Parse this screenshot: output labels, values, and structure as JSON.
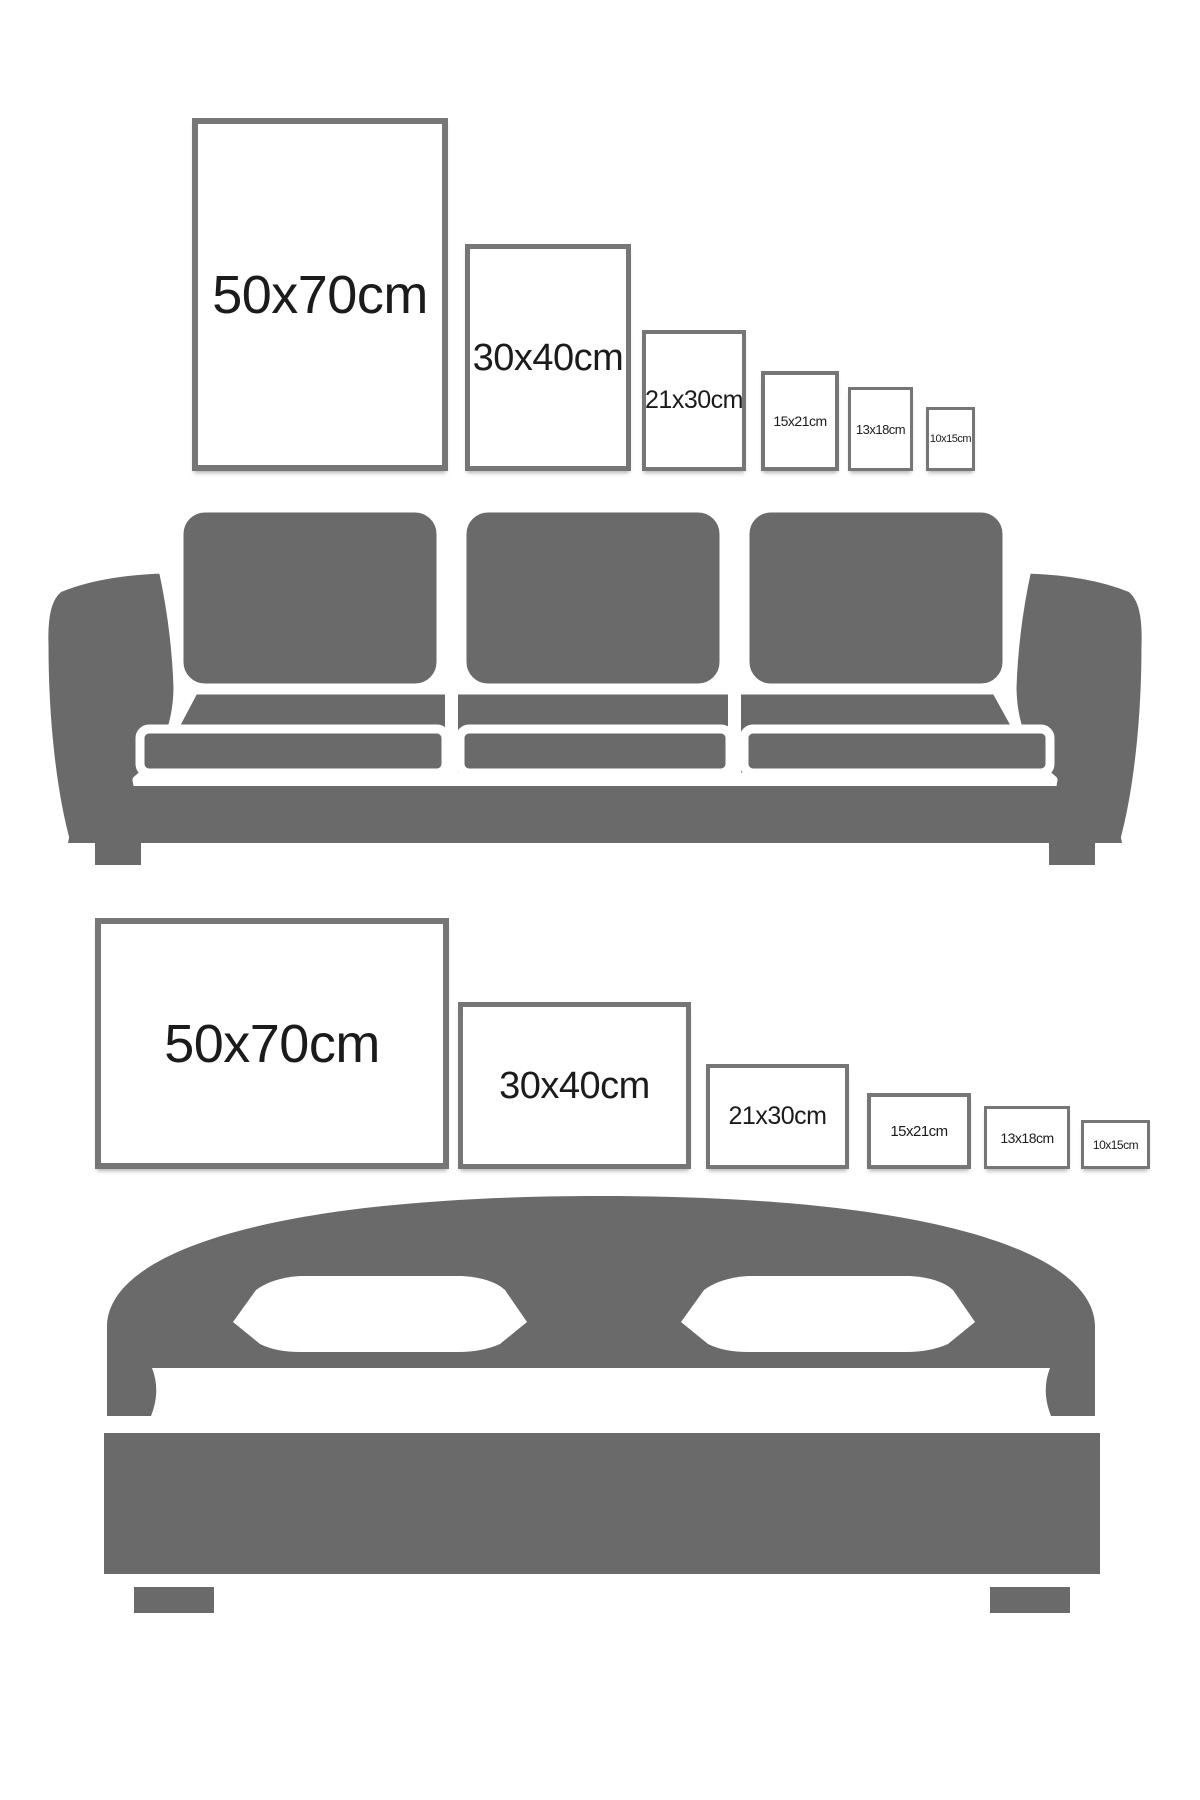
{
  "size_guide": {
    "rows": [
      {
        "name": "portrait-frames-above-sofa",
        "furniture": "sofa",
        "frames": [
          {
            "size": "50x70cm"
          },
          {
            "size": "30x40cm"
          },
          {
            "size": "21x30cm"
          },
          {
            "size": "15x21cm"
          },
          {
            "size": "13x18cm"
          },
          {
            "size": "10x15cm"
          }
        ]
      },
      {
        "name": "landscape-frames-above-bed",
        "furniture": "bed",
        "frames": [
          {
            "size": "50x70cm"
          },
          {
            "size": "30x40cm"
          },
          {
            "size": "21x30cm"
          },
          {
            "size": "15x21cm"
          },
          {
            "size": "13x18cm"
          },
          {
            "size": "10x15cm"
          }
        ]
      }
    ]
  },
  "icons": {
    "sofa": "sofa-illustration",
    "bed": "bed-illustration"
  },
  "colors": {
    "furniture_gray": "#6a6a6a",
    "frame_border_gray": "#767676",
    "label_text": "#1b1b1b",
    "background": "#ffffff"
  }
}
